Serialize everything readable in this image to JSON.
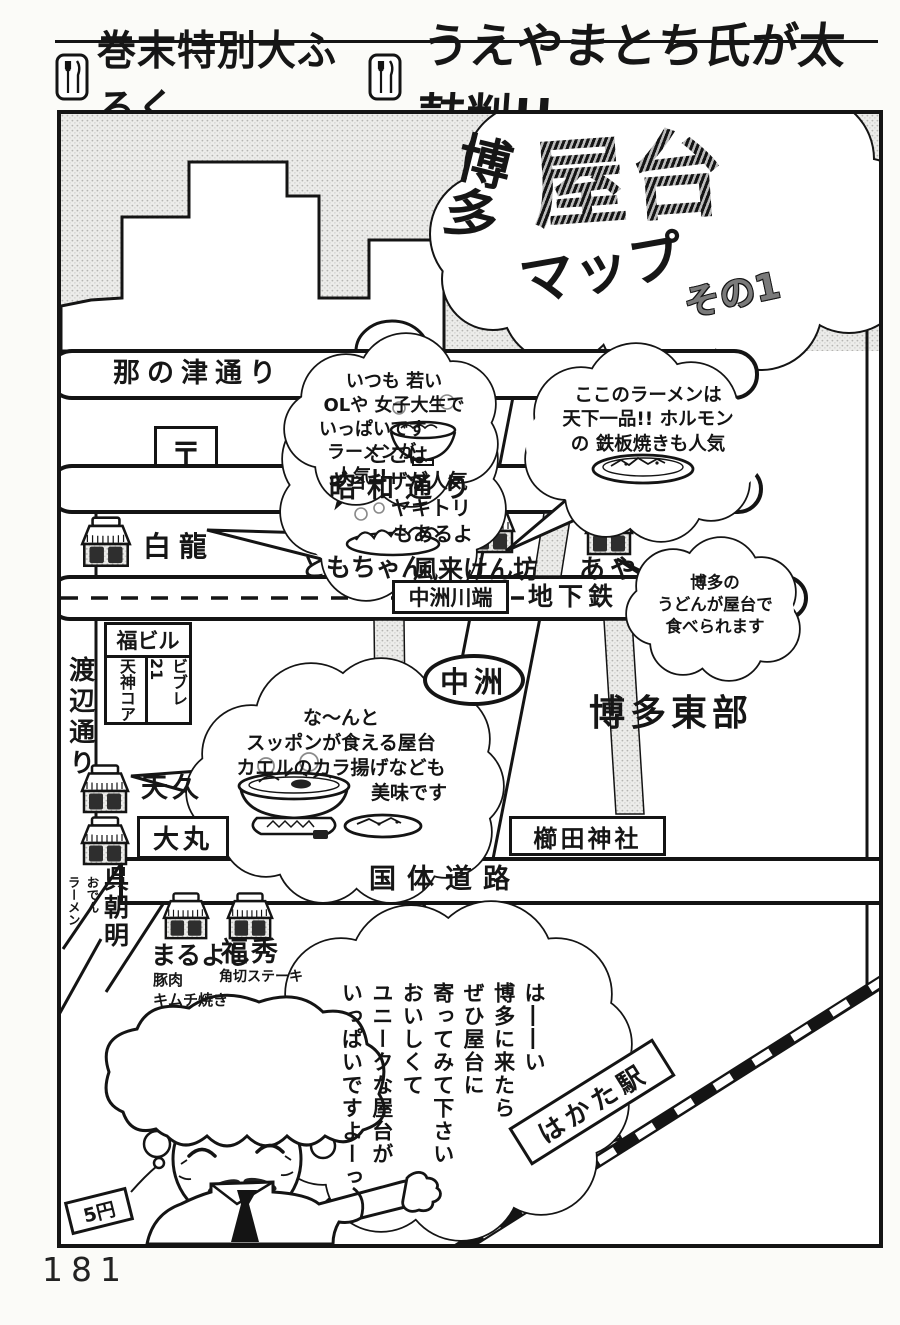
{
  "page": {
    "number": "181"
  },
  "header": {
    "appendix": "巻末特別大ふろく",
    "endorsement": "うえやまとち氏が太鼓判!!"
  },
  "title": {
    "region": "博多",
    "main": "屋台",
    "sub": "マップ",
    "part": "その1"
  },
  "streets": {
    "nanotsu": "那の津通り",
    "showa": "昭和通り",
    "watanabe": "渡辺通り",
    "kokutai": "国体道路",
    "subway_station": "中洲川端",
    "subway": "地下鉄"
  },
  "places": {
    "post_mark": "〒",
    "fuku_bldg": "福ビル",
    "tenjin_core": "天神コア",
    "vivre": "ビブレ21",
    "nakasu": "中洲",
    "hakata_east": "博多東部",
    "kushida": "櫛田神社",
    "daimaru": "大丸",
    "hakata_station": "はかた駅"
  },
  "stalls": [
    {
      "name": "白龍"
    },
    {
      "name": "ともちゃん"
    },
    {
      "name": "風来けん坊"
    },
    {
      "name": "あや"
    },
    {
      "name": "天久"
    },
    {
      "name": "呉朝明",
      "note1": "おでん",
      "note2": "ラーメン"
    },
    {
      "name": "まるよし",
      "note1": "豚肉",
      "note2": "キムチ焼き"
    },
    {
      "name": "福秀",
      "note1": "角切ステーキ"
    }
  ],
  "bubbles": {
    "gyoza": {
      "l1": "ここは",
      "l2": "ギョーザが人気",
      "l3": "ヤキトリ",
      "l4": "もあるよ",
      "l5": "よ"
    },
    "ramen": {
      "l1": "いつも 若い",
      "l2": "OLや 女子大生で",
      "l3": "いっぱいです",
      "l4": "ラーメンが",
      "l5": "人気!!"
    },
    "tenka": {
      "l1": "ここのラーメンは",
      "l2": "天下一品!! ホルモン",
      "l3": "の 鉄板焼きも人気"
    },
    "udon": {
      "l1": "博多の",
      "l2": "うどんが屋台で",
      "l3": "食べられます"
    },
    "suppon": {
      "l1": "な〜んと",
      "l2": "スッポンが食える屋台",
      "l3": "カエルのカラ揚げなども",
      "l4": "美味です"
    },
    "speech": {
      "c1": "は――い",
      "c2": "博多に来たら",
      "c3": "ぜひ屋台に",
      "c4": "寄ってみて下さい",
      "c5": "おいしくて",
      "c6": "ユニークな屋台が",
      "c7": "いっぱいですよーっ"
    }
  },
  "character": {
    "tag": "5円"
  }
}
